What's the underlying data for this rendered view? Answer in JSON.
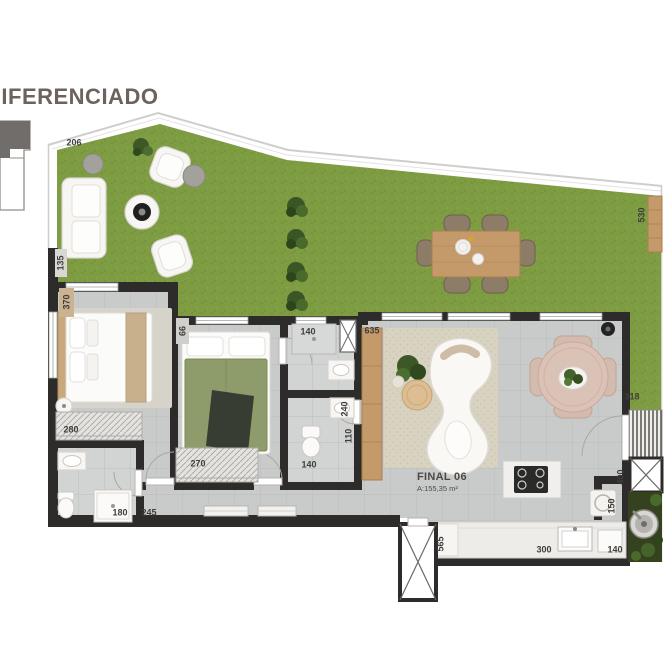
{
  "title": "DIFERENCIADO",
  "unit": {
    "name": "FINAL 06",
    "area": "A:155,35 m²"
  },
  "colors": {
    "title": "#6e615e",
    "label": "#3f3e3b",
    "wall": "#2d2c2a",
    "floor": "#c9cbca",
    "floor_line": "#bcbebd",
    "grass": "#7e9c42",
    "grass_texture": "#6f8c36",
    "rug": "#d8d2c0",
    "wood": "#c59a6a",
    "wood_dark": "#a87f4e",
    "planter": "#35421f",
    "leaf": "#44642c",
    "furniture_white": "#f7f6f3",
    "furniture_stroke": "#d8d5d0",
    "terrace_chair": "#8d7c68",
    "dining_table_rose": "#dbc2b6",
    "dining_chair_rose": "#d3bcae",
    "bed_olive": "#8e9b6a"
  },
  "dimension_labels": [
    {
      "text": "206",
      "x": 74,
      "y": 143,
      "rot": 0
    },
    {
      "text": "530",
      "x": 642,
      "y": 215,
      "rot": 90
    },
    {
      "text": "318",
      "x": 632,
      "y": 397,
      "rot": 0
    },
    {
      "text": "135",
      "x": 61,
      "y": 263,
      "rot": 90
    },
    {
      "text": "370",
      "x": 67,
      "y": 302,
      "rot": 90
    },
    {
      "text": "66",
      "x": 183,
      "y": 331,
      "rot": 90
    },
    {
      "text": "140",
      "x": 308,
      "y": 332,
      "rot": 0
    },
    {
      "text": "635",
      "x": 372,
      "y": 331,
      "rot": 0
    },
    {
      "text": "240",
      "x": 345,
      "y": 409,
      "rot": 90
    },
    {
      "text": "110",
      "x": 349,
      "y": 436,
      "rot": 90
    },
    {
      "text": "140",
      "x": 309,
      "y": 465,
      "rot": 0
    },
    {
      "text": "280",
      "x": 71,
      "y": 430,
      "rot": 0
    },
    {
      "text": "270",
      "x": 198,
      "y": 464,
      "rot": 0
    },
    {
      "text": "180",
      "x": 120,
      "y": 513,
      "rot": 0
    },
    {
      "text": "245",
      "x": 149,
      "y": 513,
      "rot": 0
    },
    {
      "text": "400",
      "x": 621,
      "y": 477,
      "rot": 90
    },
    {
      "text": "150",
      "x": 612,
      "y": 506,
      "rot": 90
    },
    {
      "text": "565",
      "x": 441,
      "y": 544,
      "rot": 90
    },
    {
      "text": "300",
      "x": 544,
      "y": 550,
      "rot": 0
    },
    {
      "text": "140",
      "x": 615,
      "y": 550,
      "rot": 0
    }
  ]
}
